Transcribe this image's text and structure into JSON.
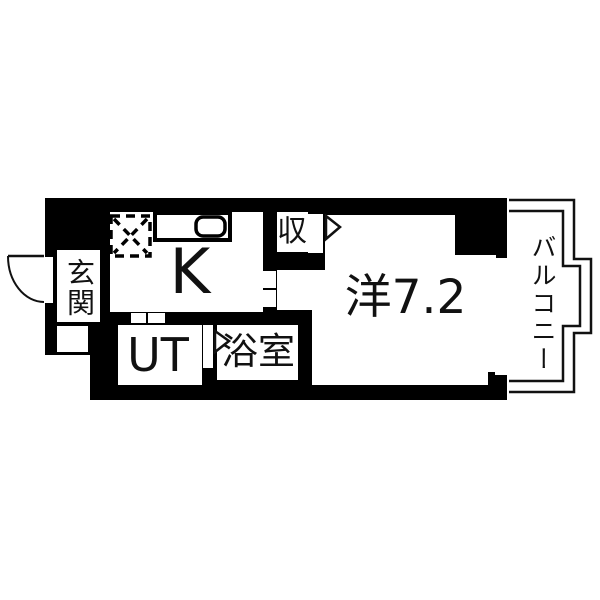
{
  "title": "Japanese apartment floor plan (1K layout)",
  "colors": {
    "wall": "#000000",
    "floor": "#ffffff",
    "line": "#111111"
  },
  "rooms": {
    "entrance": {
      "label": "玄関"
    },
    "kitchen": {
      "label": "K"
    },
    "utility": {
      "label": "UT"
    },
    "bathroom": {
      "label": "浴室"
    },
    "western_room": {
      "label": "洋7.2"
    },
    "closet": {
      "label": "収"
    },
    "balcony": {
      "label": "バルコニー"
    }
  },
  "fixtures": {
    "stove": "gas-stove-dashed-square",
    "sink": "kitchen-counter-with-sink",
    "entrance_door": "outward-swing-door-arc",
    "closet_door": "folding-door-triangle",
    "bathroom_door": "folding-door-triangle",
    "window": "sliding-window",
    "sliding_doors": "white-gap-door-markers"
  }
}
